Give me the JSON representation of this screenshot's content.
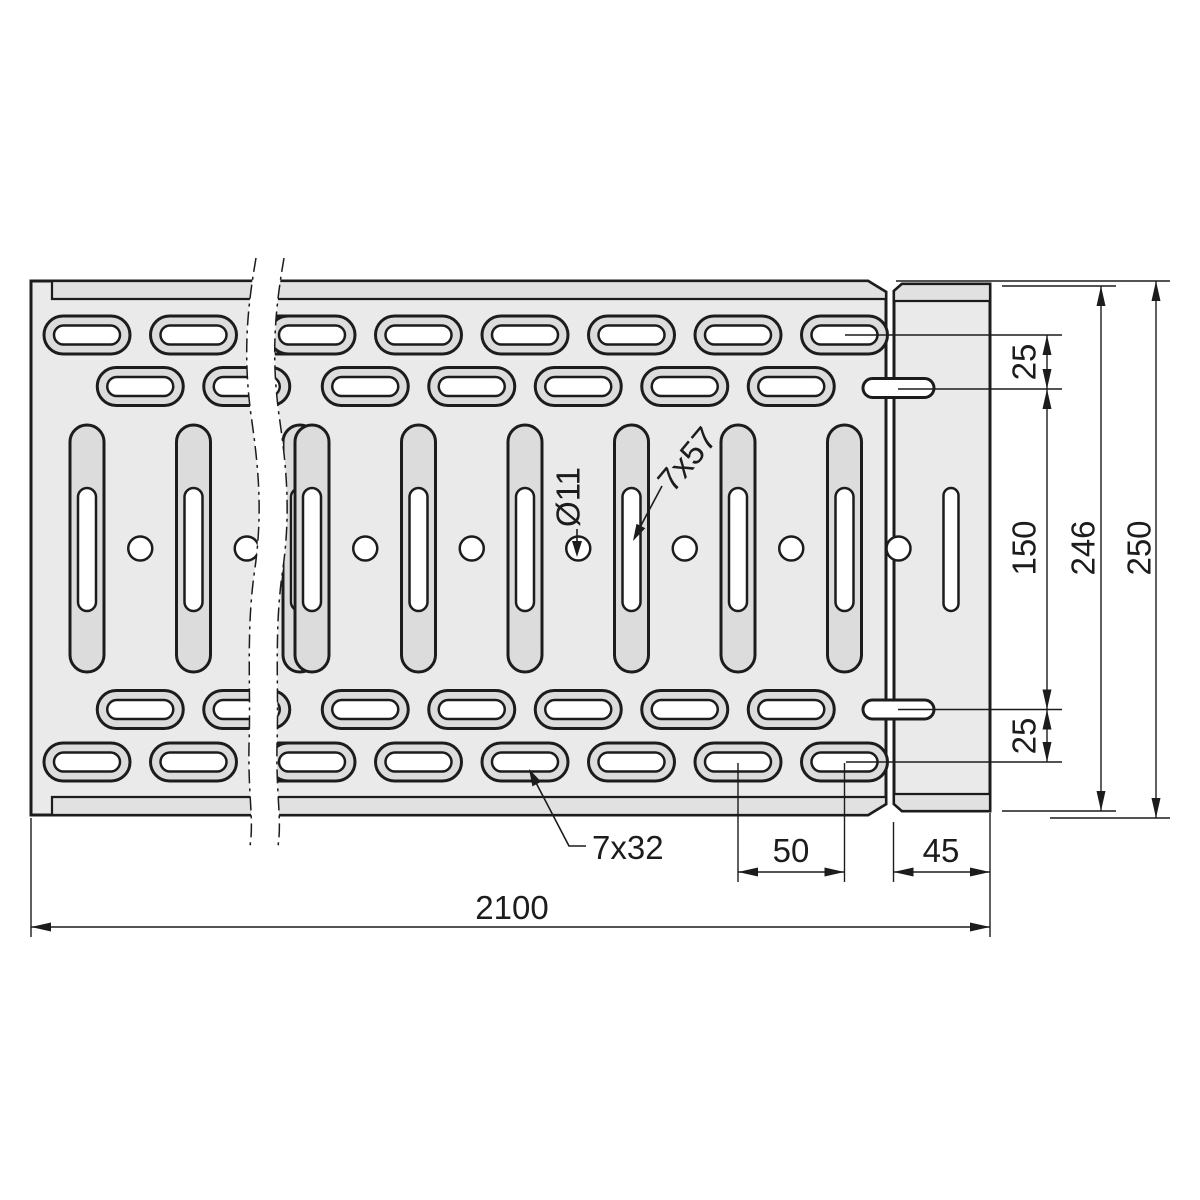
{
  "drawing": {
    "type": "technical-drawing-cable-tray",
    "dimensions": {
      "total_length": "2100",
      "overall_height": "250",
      "connector_height": "246",
      "row_spacing": "150",
      "top_offset": "25",
      "bottom_offset": "25",
      "hole_pitch": "50",
      "connector_length": "45"
    },
    "annotations": {
      "round_hole": "Ø11",
      "long_slot": "7x57",
      "short_slot": "7x32"
    },
    "colors": {
      "line": "#1c1c1c",
      "part_fill": "#eaeaea",
      "strip_fill": "#e1e1e1",
      "emboss_fill": "#dcdcdc",
      "hole_fill": "#ffffff",
      "background": "#ffffff"
    }
  }
}
